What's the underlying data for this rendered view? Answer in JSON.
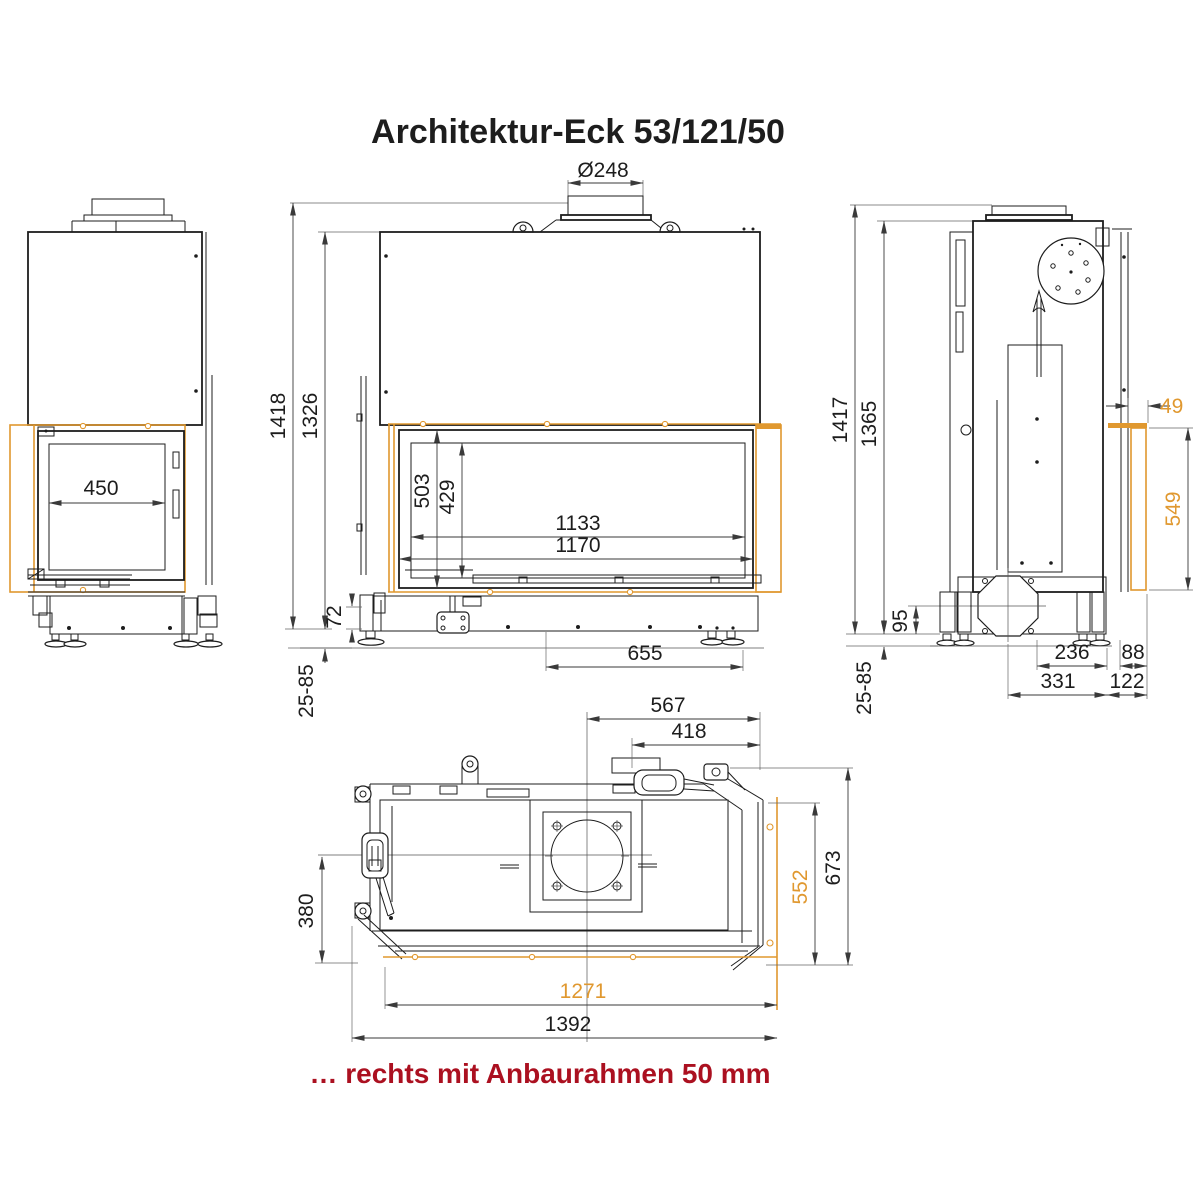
{
  "title": "Architektur-Eck 53/121/50",
  "caption": "… rechts mit Anbaurahmen 50 mm",
  "colors": {
    "accent_orange": "#e0982f",
    "caption_red": "#ab1020",
    "line_black": "#1d1d1d"
  },
  "views": {
    "left_side": {
      "dims": {
        "door_width": "450"
      }
    },
    "front": {
      "dims": {
        "flue_diameter": "Ø248",
        "total_height": "1418",
        "body_height": "1326",
        "glass_height_outer": "503",
        "glass_height_inner": "429",
        "glass_width_inner": "1133",
        "glass_width_outer": "1170",
        "plinth_height": "72",
        "feet_adjust_range": "25-85",
        "base_length": "655"
      }
    },
    "right_side": {
      "dims": {
        "total_height": "1417",
        "body_height": "1365",
        "frame_offset": "49",
        "frame_height": "549",
        "air_inlet_height": "95",
        "feet_adjust_range": "25-85",
        "base_width_inner": "236",
        "front_offset": "88",
        "base_width_outer": "331",
        "side_offset": "122"
      }
    },
    "top": {
      "dims": {
        "flue_center_to_right": "567",
        "latch_to_right": "418",
        "front_depth": "380",
        "frame_depth": "552",
        "total_depth": "673",
        "frame_width": "1271",
        "total_width": "1392"
      }
    }
  }
}
